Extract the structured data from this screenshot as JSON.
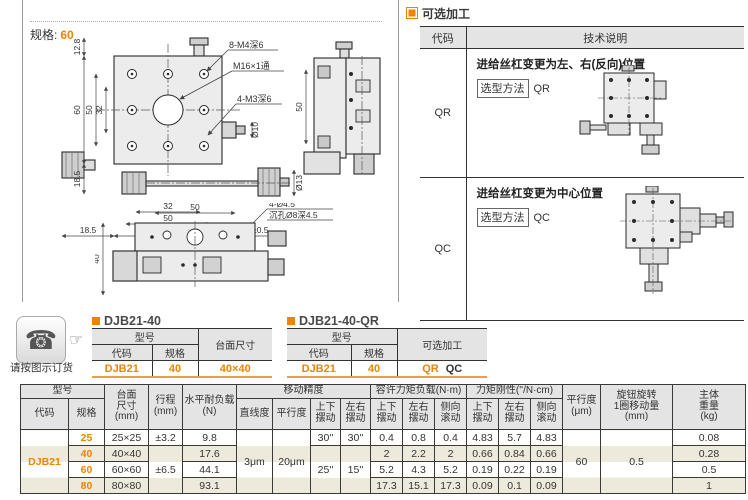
{
  "accent": "#f08300",
  "left": {
    "spec_label": "规格:",
    "spec_value": "60",
    "front": {
      "dim_12_8": "12.8",
      "dim_60": "60",
      "dim_50": "50",
      "dim_32": "32",
      "dim_18_5_left": "18.5",
      "label_8m4": "8-M4深6",
      "label_m16": "M16×1通",
      "label_4m3": "4-M3深6",
      "dia10": "Ø10",
      "dia13": "Ø13",
      "dim_b32": "32",
      "dim_b50": "50",
      "dim_b60": "60",
      "dim_b18_5": "18.5",
      "dim_b17_3": "17.3±0.5"
    },
    "side": {
      "dim_50": "50"
    },
    "bottom": {
      "dim_50": "50",
      "dim_40": "40",
      "hole_label1": "4-Ø4.5",
      "hole_label2": "沉孔Ø8深4.5"
    }
  },
  "optional": {
    "title": "可选加工",
    "col_code": "代码",
    "col_desc": "技术说明",
    "rows": [
      {
        "code": "QR",
        "desc": "进给丝杠变更为左、右(反向)位置",
        "method_label": "选型方法",
        "method_value": "QR"
      },
      {
        "code": "QC",
        "desc": "进给丝杠变更为中心位置",
        "method_label": "选型方法",
        "method_value": "QC"
      }
    ]
  },
  "order": {
    "note": "请按图示订货",
    "table_a": {
      "title": "DJB21-40",
      "h_model": "型号",
      "h_code": "代码",
      "h_spec": "规格",
      "h_extra": "台面尺寸",
      "v_code": "DJB21",
      "v_spec": "40",
      "v_extra": "40×40"
    },
    "table_b": {
      "title": "DJB21-40-QR",
      "h_model": "型号",
      "h_code": "代码",
      "h_spec": "规格",
      "h_extra": "可选加工",
      "v_code": "DJB21",
      "v_spec": "40",
      "v_extra_1": "QR",
      "v_extra_2": "QC"
    }
  },
  "spec_table": {
    "h_model": "型号",
    "h_code": "代码",
    "h_spec": "规格",
    "h_surface": "台面\n尺寸\n(mm)",
    "h_travel": "行程\n(mm)",
    "h_load": "水平耐负载\n(N)",
    "h_accuracy": "移动精度",
    "h_straightness": "直线度",
    "h_parallelism": "平行度",
    "h_pitch": "上下\n摆动",
    "h_yaw": "左右\n摆动",
    "h_roll": "侧向\n滚动",
    "h_moment": "容许力矩负载(N·m)",
    "h_rigidity": "力矩刚性(''/N·cm)",
    "h_parallelism2": "平行度\n(μm)",
    "h_knob": "旋钮旋转\n1圈移动量\n(mm)",
    "h_weight": "主体\n重量\n(kg)",
    "code": "DJB21",
    "straightness": "3μm",
    "parallelism": "20μm",
    "parallelism2": "60",
    "knob_travel": "0.5",
    "travel_25": "±3.2",
    "travel_40_80": "±6.5",
    "pitch_25": "30''",
    "yaw_25": "30''",
    "pitch_40_80": "25''",
    "yaw_40_80": "15''",
    "rows": [
      {
        "spec": "25",
        "surface": "25×25",
        "load": "9.8",
        "m_pitch": "0.4",
        "m_yaw": "0.8",
        "m_roll": "0.4",
        "r_pitch": "4.83",
        "r_yaw": "5.7",
        "r_roll": "4.83",
        "weight": "0.08"
      },
      {
        "spec": "40",
        "surface": "40×40",
        "load": "17.6",
        "m_pitch": "2",
        "m_yaw": "2.2",
        "m_roll": "2",
        "r_pitch": "0.66",
        "r_yaw": "0.84",
        "r_roll": "0.66",
        "weight": "0.28"
      },
      {
        "spec": "60",
        "surface": "60×60",
        "load": "44.1",
        "m_pitch": "5.2",
        "m_yaw": "4.3",
        "m_roll": "5.2",
        "r_pitch": "0.19",
        "r_yaw": "0.22",
        "r_roll": "0.19",
        "weight": "0.5"
      },
      {
        "spec": "80",
        "surface": "80×80",
        "load": "93.1",
        "m_pitch": "17.3",
        "m_yaw": "15.1",
        "m_roll": "17.3",
        "r_pitch": "0.09",
        "r_yaw": "0.1",
        "r_roll": "0.09",
        "weight": "1"
      }
    ]
  }
}
